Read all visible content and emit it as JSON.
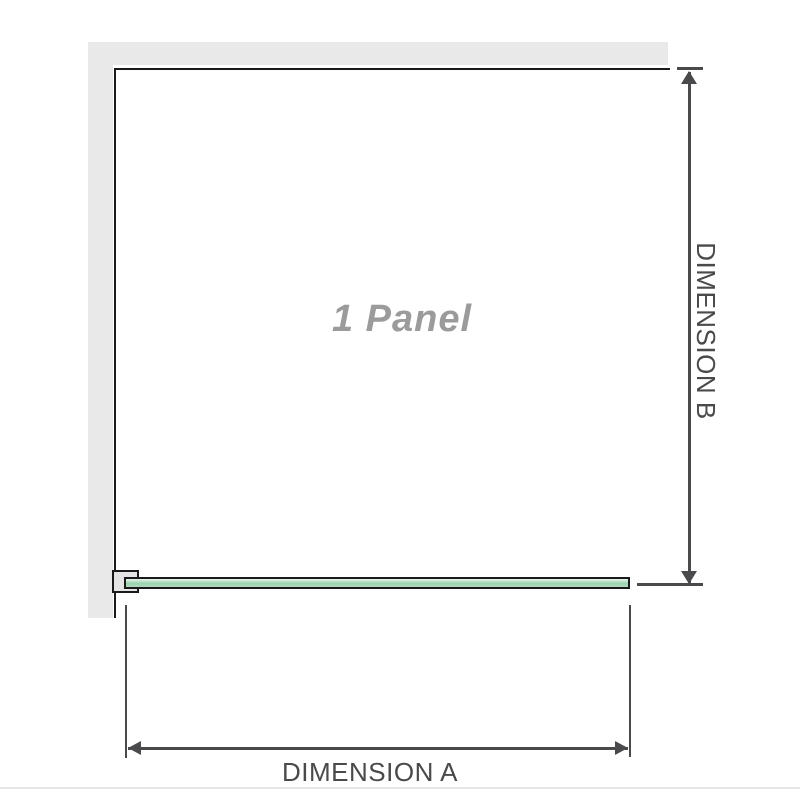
{
  "diagram": {
    "panel_label": "1 Panel",
    "dimensions": {
      "a": {
        "label": "DIMENSION A"
      },
      "b": {
        "label": "DIMENSION B"
      }
    },
    "colors": {
      "wall": "#e9e9e9",
      "bracket_fill": "#e5e5e5",
      "outline": "#1a1a1a",
      "dimension_line": "#4a4a4d",
      "glass_light": "#e8f5ec",
      "glass_mid": "#9ad3b1",
      "glass_low": "#aedcbf",
      "label_gray": "#9b9b9b",
      "separator": "#e7e6e2"
    }
  }
}
